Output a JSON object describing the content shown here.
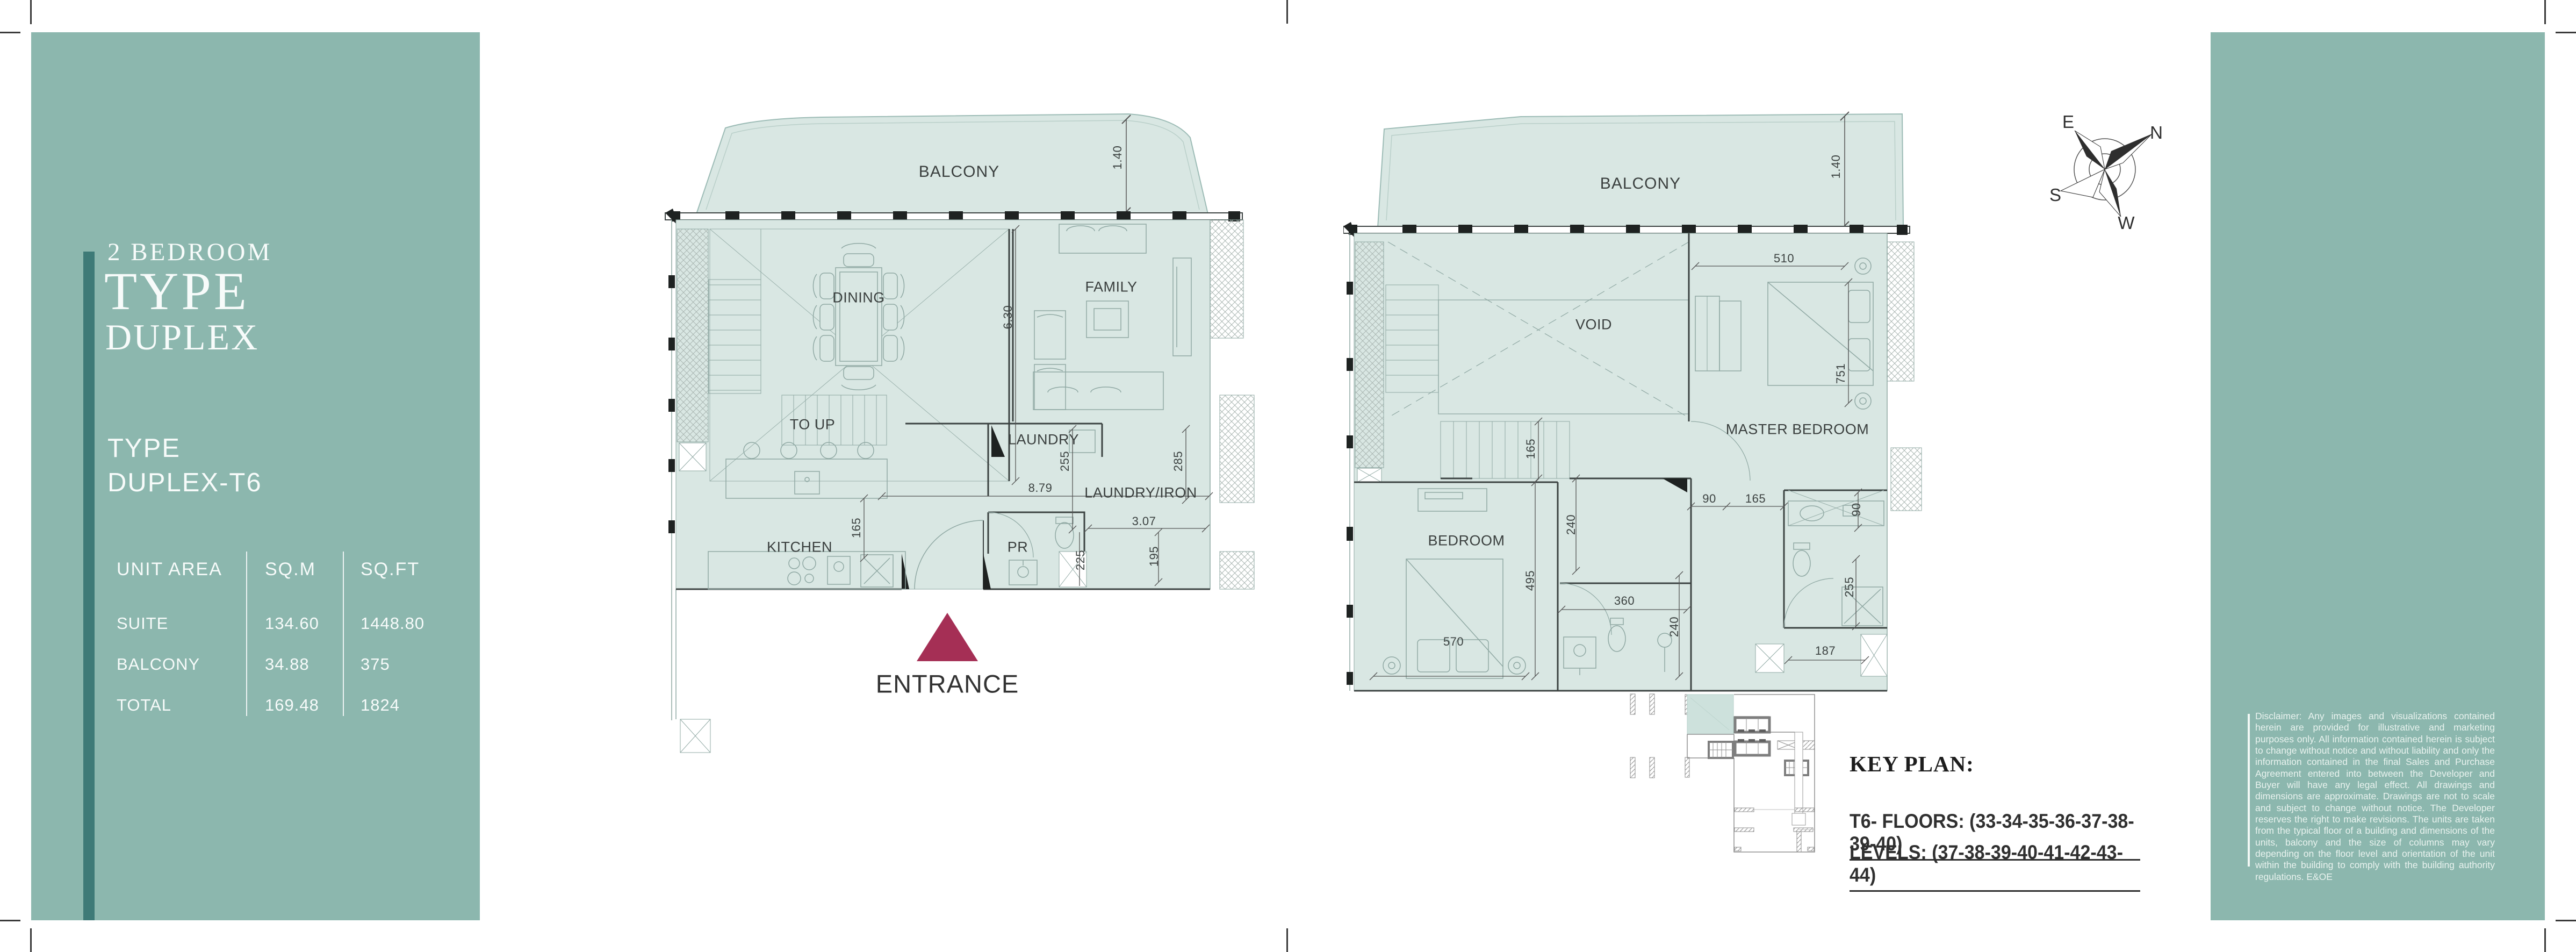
{
  "colors": {
    "sidebar": "#8cb7ae",
    "accent": "#3e7a77",
    "floor": "#d9e7e3",
    "wall": "#3c4342",
    "thin": "#8fa8a3",
    "entrance": "#a52f55",
    "keyplan_teal": "#cde1dc"
  },
  "left_panel": {
    "title_line1": "2 BEDROOM",
    "title_line2": "TYPE",
    "title_line3": "DUPLEX",
    "subtitle_line1": "TYPE",
    "subtitle_line2": "DUPLEX-T6",
    "area_table": {
      "headers": [
        "UNIT AREA",
        "SQ.M",
        "SQ.FT"
      ],
      "rows": [
        {
          "label": "SUITE",
          "sqm": "134.60",
          "sqft": "1448.80"
        },
        {
          "label": "BALCONY",
          "sqm": "34.88",
          "sqft": "375"
        },
        {
          "label": "TOTAL",
          "sqm": "169.48",
          "sqft": "1824"
        }
      ]
    }
  },
  "plan_lower": {
    "labels": {
      "balcony": "BALCONY",
      "dining": "DINING",
      "family": "FAMILY",
      "toup": "TO UP",
      "kitchen": "KITCHEN",
      "laundry": "LAUNDRY",
      "laundry_iron": "LAUNDRY/IRON",
      "pr": "PR"
    },
    "dims": {
      "d140": "1.40",
      "d630": "6.30",
      "d879": "8.79",
      "d165": "165",
      "d255": "255",
      "d285": "285",
      "d307": "3.07",
      "d225": "225",
      "d195": "195"
    }
  },
  "entrance": {
    "label": "ENTRANCE"
  },
  "plan_upper": {
    "labels": {
      "balcony": "BALCONY",
      "void": "VOID",
      "master": "MASTER BEDROOM",
      "bedroom": "BEDROOM"
    },
    "dims": {
      "d140": "1.40",
      "d510": "510",
      "d751": "751",
      "d165": "165",
      "d90a": "90",
      "d165b": "165",
      "d90b": "90",
      "d240a": "240",
      "d495": "495",
      "d570": "570",
      "d360": "360",
      "d240b": "240",
      "d255": "255",
      "d187": "187"
    }
  },
  "compass": {
    "n": "N",
    "e": "E",
    "s": "S",
    "w": "W"
  },
  "key_plan": {
    "heading": "KEY PLAN:",
    "floors_line": "T6- FLOORS: (33-34-35-36-37-38-39-40)",
    "levels_line": "LEVELS: (37-38-39-40-41-42-43-44)"
  },
  "disclaimer": {
    "text": "Disclaimer: Any images and visualizations contained herein are provided for illustrative and marketing purposes only. All information contained herein is subject to change without notice and without liability and only the information contained in the final Sales and Purchase Agreement entered into between the Developer and Buyer will have any legal effect. All drawings and dimensions are approximate.  Drawings are not to scale and subject to change without notice. The Developer reserves the right to make revisions.  The units are taken from the typical floor of a building and dimensions of the units, balcony and the size of columns may vary depending on the floor level and orientation of the unit within the building to comply with the building authority regulations. E&OE"
  }
}
